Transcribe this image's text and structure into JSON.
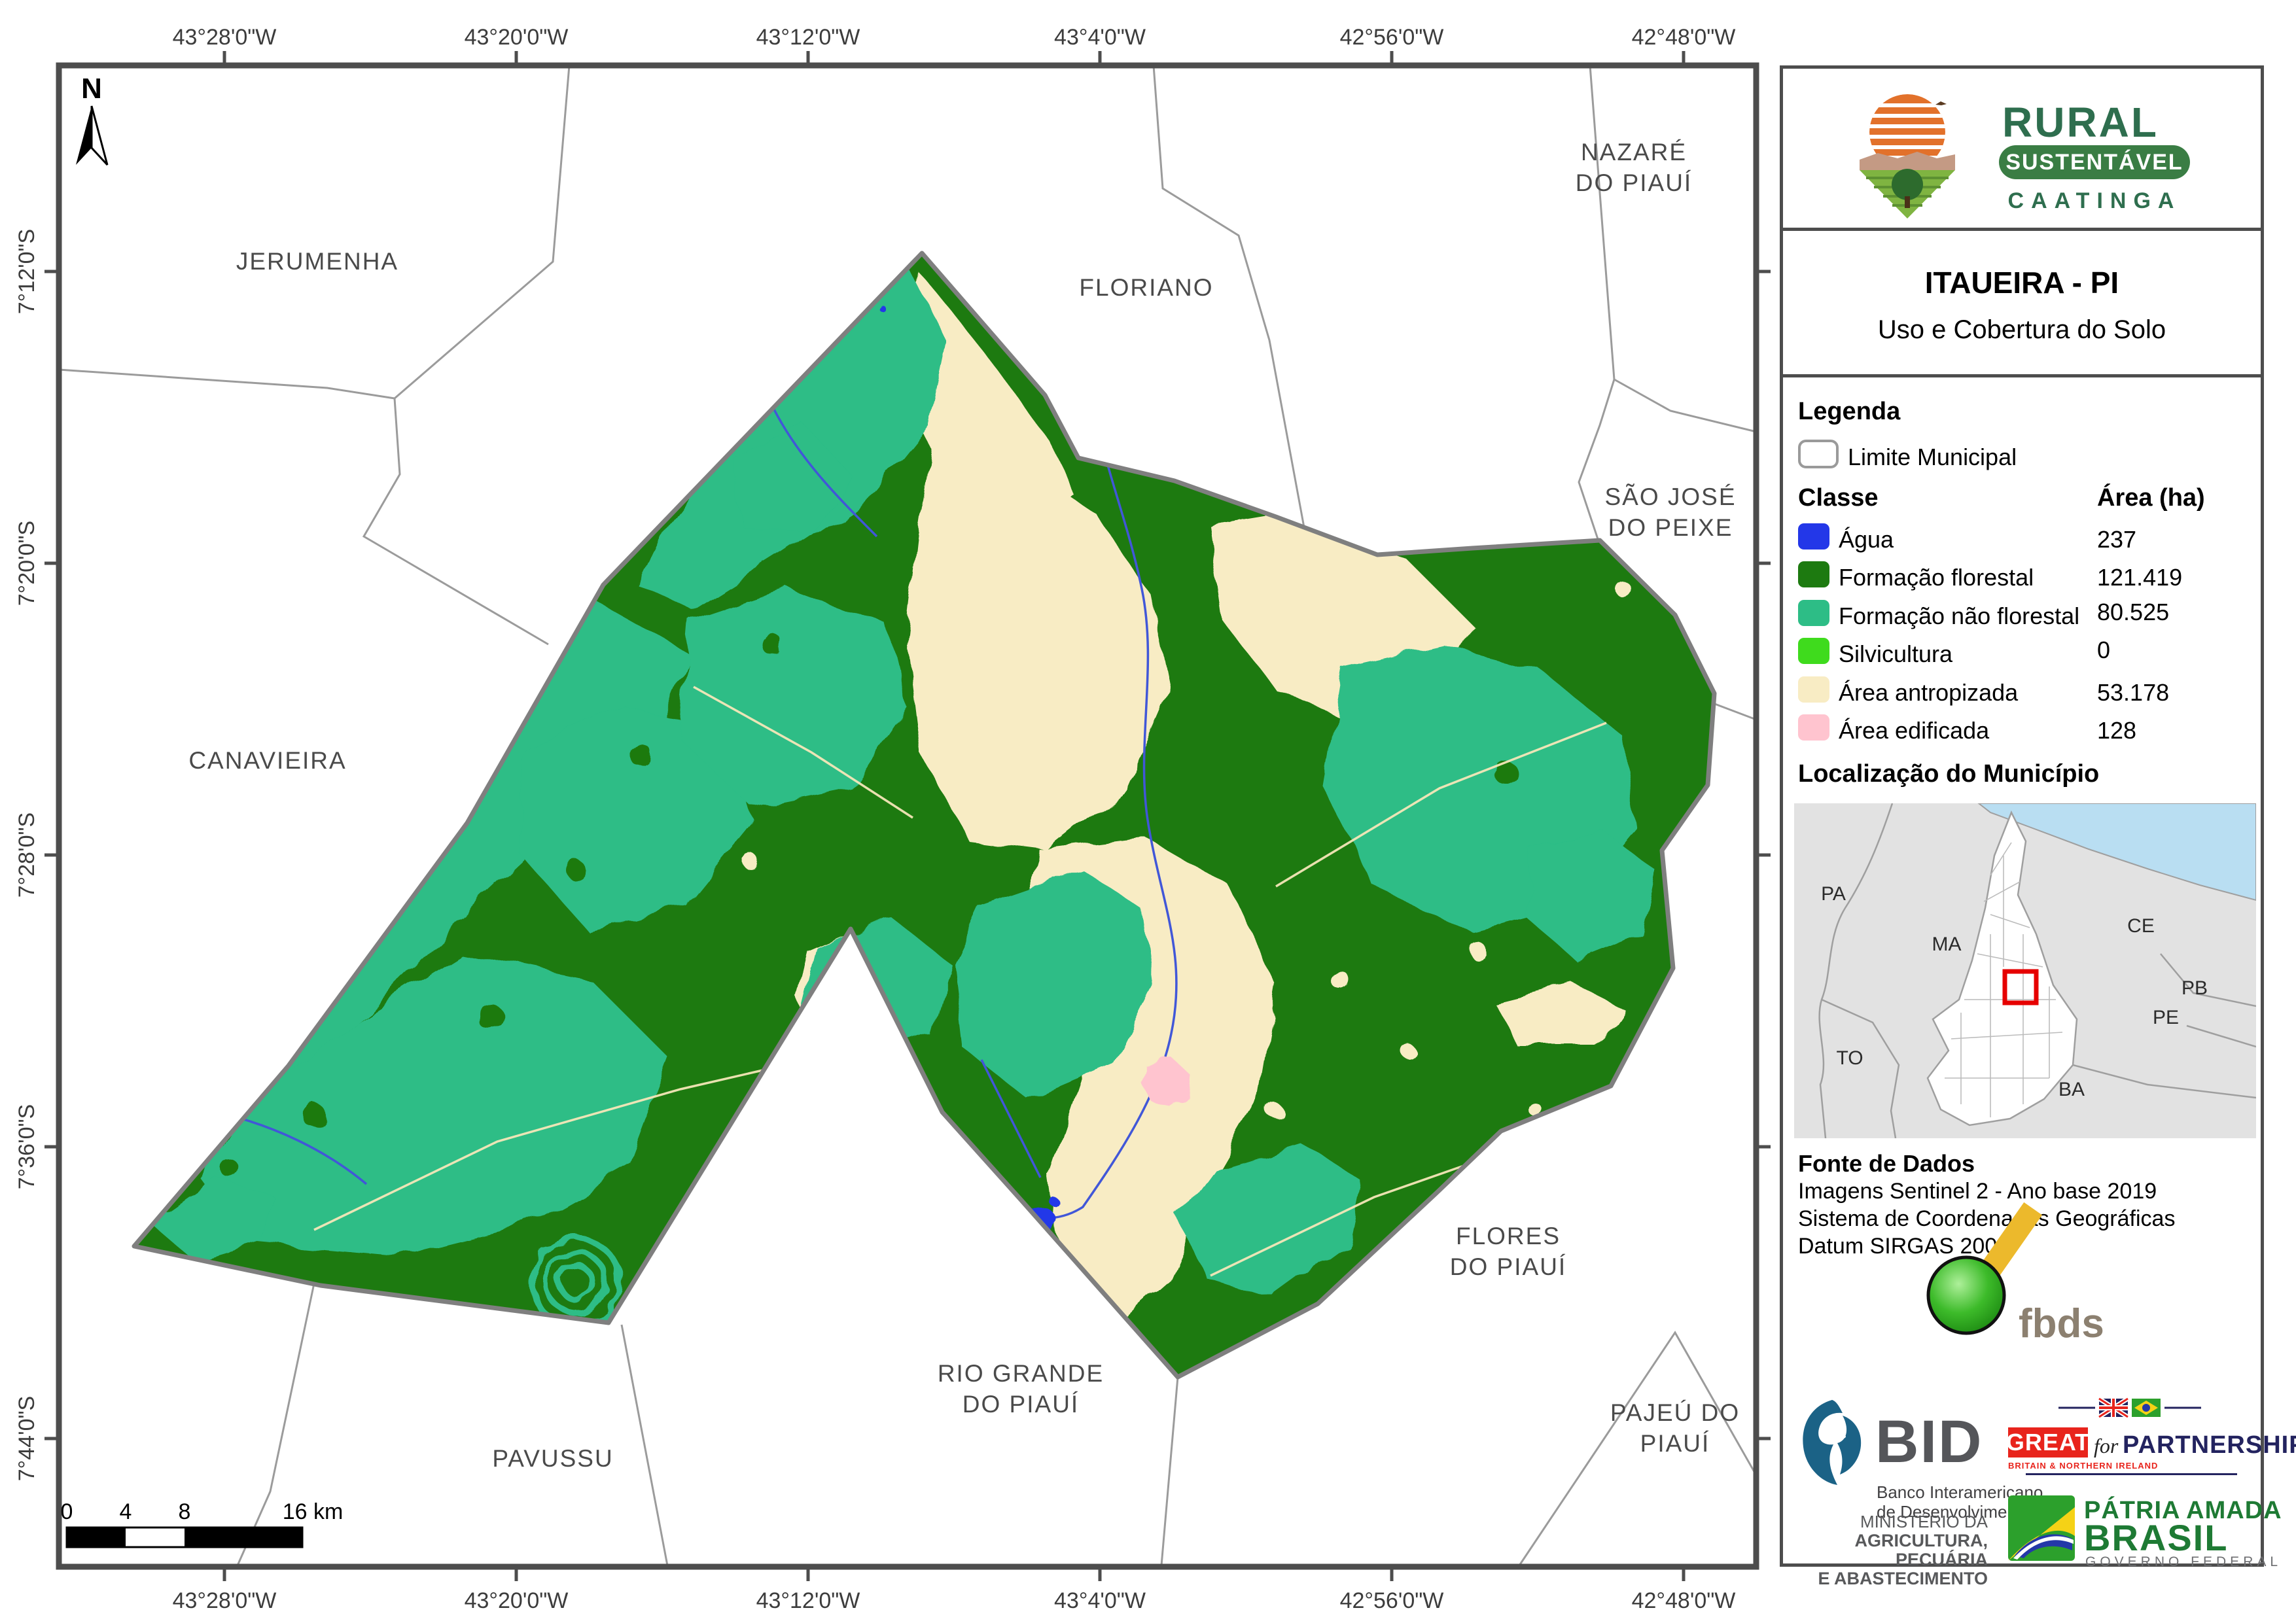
{
  "colors": {
    "agua": "#2337e8",
    "formacao_florestal": "#1d7a10",
    "formacao_nao_florestal": "#2dbd86",
    "silvicultura": "#3fdb1d",
    "area_antropizada": "#f8ecc4",
    "area_edificada": "#ffc4cf",
    "frame": "#4d4d4d",
    "municipality_outline": "#7f7f7f",
    "neighbor_line": "#9b9b9b",
    "great_red": "#e8241c",
    "partnership_navy": "#23235f",
    "rural_green": "#2e6e4e"
  },
  "map": {
    "north_label": "N",
    "lon_labels": [
      "43°28'0\"W",
      "43°20'0\"W",
      "43°12'0\"W",
      "43°4'0\"W",
      "42°56'0\"W",
      "42°48'0\"W"
    ],
    "lat_labels": [
      "7°12'0\"S",
      "7°20'0\"S",
      "7°28'0\"S",
      "7°36'0\"S",
      "7°44'0\"S"
    ],
    "neighbors": [
      {
        "text": "JERUMENHA"
      },
      {
        "text": "FLORIANO"
      },
      {
        "text": "NAZARÉ"
      },
      {
        "text": "DO PIAUÍ"
      },
      {
        "text": "SÃO JOSÉ"
      },
      {
        "text": "DO PEIXE"
      },
      {
        "text": "CANAVIEIRA"
      },
      {
        "text": "FLORES"
      },
      {
        "text": "DO PIAUÍ"
      },
      {
        "text": "RIO GRANDE"
      },
      {
        "text": "DO PIAUÍ"
      },
      {
        "text": "PAVUSSU"
      },
      {
        "text": "PAJEÚ DO"
      },
      {
        "text": "PIAUÍ"
      }
    ],
    "scale_bar": {
      "t0": "0",
      "t4": "4",
      "t8": "8",
      "t16": "16 km"
    }
  },
  "sidebar": {
    "logo": {
      "line1": "RURAL",
      "line2": "SUSTENTÁVEL",
      "line3": "CAATINGA"
    },
    "title": "ITAUEIRA - PI",
    "subtitle": "Uso e Cobertura do Solo",
    "legend": {
      "heading": "Legenda",
      "limite": "Limite Municipal",
      "col_classe": "Classe",
      "col_area": "Área (ha)",
      "rows": [
        {
          "label": "Água",
          "area": "237",
          "color": "#2337e8"
        },
        {
          "label": "Formação florestal",
          "area": "121.419",
          "color": "#1d7a10"
        },
        {
          "label": "Formação não florestal",
          "area": "80.525",
          "color": "#2dbd86"
        },
        {
          "label": "Silvicultura",
          "area": "0",
          "color": "#3fdb1d"
        },
        {
          "label": "Área antropizada",
          "area": "53.178",
          "color": "#f8ecc4"
        },
        {
          "label": "Área edificada",
          "area": "128",
          "color": "#ffc4cf"
        }
      ]
    },
    "localizacao": {
      "heading": "Localização do Município",
      "states": [
        "PA",
        "MA",
        "TO",
        "CE",
        "PB",
        "PE",
        "BA"
      ]
    },
    "fonte": {
      "heading": "Fonte de Dados",
      "lines": [
        "Imagens Sentinel 2 - Ano base 2019",
        "Sistema de Coordenadas Geográficas",
        "Datum SIRGAS 2000"
      ]
    },
    "logos": {
      "fbds": "fbds",
      "bid": {
        "name": "BID",
        "sub1": "Banco Interamericano",
        "sub2": "de Desenvolvimento"
      },
      "great": {
        "great": "GREAT",
        "for_word": "for",
        "partnership": "PARTNERSHIP",
        "sub": "BRITAIN & NORTHERN IRELAND"
      },
      "ministerio": {
        "l1": "MINISTÉRIO DA",
        "l2": "AGRICULTURA, PECUÁRIA",
        "l3": "E ABASTECIMENTO"
      },
      "patria": {
        "line1": "PÁTRIA AMADA",
        "line2": "BRASIL",
        "line3": "GOVERNO FEDERAL"
      }
    }
  }
}
